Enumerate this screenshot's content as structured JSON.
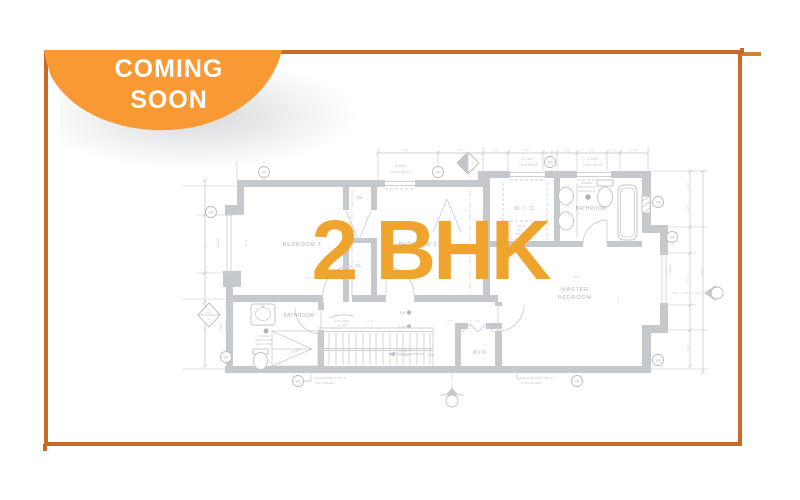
{
  "badge": {
    "line1": "COMING",
    "line2": "SOON",
    "bg_color": "#f99933",
    "text_color": "#ffffff"
  },
  "frame": {
    "border_color": "#cb6a28"
  },
  "overlay": {
    "title": "2 BHK",
    "color": "#efa42d"
  },
  "floorplan": {
    "wall_color": "#c5c9cd",
    "labels": [
      {
        "t": "BEDROOM 3",
        "x": 302,
        "y": 246,
        "s": 5.5,
        "k": "room",
        "ls": 0.6
      },
      {
        "t": "BEDROOM 2",
        "x": 418,
        "y": 246,
        "s": 5.5,
        "k": "room",
        "ls": 0.6
      },
      {
        "t": "CL.",
        "x": 360,
        "y": 199,
        "s": 4.5,
        "k": "room"
      },
      {
        "t": "CL.",
        "x": 359,
        "y": 267,
        "s": 4.5,
        "k": "room"
      },
      {
        "t": "W. I. C.",
        "x": 525,
        "y": 210,
        "s": 5.5,
        "k": "room",
        "ls": 0.5
      },
      {
        "t": "BATHROOM",
        "x": 591,
        "y": 210,
        "s": 5,
        "k": "room",
        "ls": 0.3
      },
      {
        "t": "MASTER",
        "x": 575,
        "y": 291,
        "s": 5.5,
        "k": "room",
        "ls": 0.8
      },
      {
        "t": "BEDROOM",
        "x": 575,
        "y": 299,
        "s": 5.5,
        "k": "room",
        "ls": 0.8
      },
      {
        "t": "BATHROOM",
        "x": 299,
        "y": 317,
        "s": 5,
        "k": "room",
        "ls": 0.3
      },
      {
        "t": "W / D",
        "x": 479,
        "y": 354,
        "s": 5,
        "k": "room"
      },
      {
        "t": "DOWN",
        "x": 296,
        "y": 352,
        "s": 3.4,
        "k": "dim",
        "r": -18
      },
      {
        "t": "DN",
        "x": 430,
        "y": 356,
        "s": 4,
        "k": "dim"
      },
      {
        "t": "SA",
        "x": 405,
        "y": 314,
        "s": 4,
        "k": "room",
        "a": "end"
      },
      {
        "t": "CO",
        "x": 405,
        "y": 328,
        "s": 4,
        "k": "room",
        "a": "end"
      },
      {
        "t": "5'-8\" HIGH",
        "x": 342,
        "y": 322,
        "s": 3,
        "k": "dim"
      },
      {
        "t": "GUARD",
        "x": 342,
        "y": 326.5,
        "s": 3,
        "k": "dim"
      },
      {
        "t": "16R@7'-7\"",
        "x": 406,
        "y": 351.5,
        "s": 3,
        "k": "dim"
      },
      {
        "t": "15T@10\"",
        "x": 405,
        "y": 356,
        "s": 3,
        "k": "dim"
      },
      {
        "t": "PROVIDE",
        "x": 264,
        "y": 337,
        "s": 2.6,
        "k": "dim"
      },
      {
        "t": "MECHANICAL",
        "x": 264,
        "y": 341,
        "s": 2.6,
        "k": "dim"
      },
      {
        "t": "VENTILATION",
        "x": 264,
        "y": 345,
        "s": 2.6,
        "k": "dim"
      },
      {
        "t": "PROVIDE",
        "x": 587,
        "y": 184,
        "s": 2.6,
        "k": "dim"
      },
      {
        "t": "MECHANICAL",
        "x": 587,
        "y": 188,
        "s": 2.6,
        "k": "dim"
      },
      {
        "t": "VENTILATION",
        "x": 587,
        "y": 192,
        "s": 2.6,
        "k": "dim"
      },
      {
        "t": "PROVIDE 5/8\" TYPE 'X'",
        "x": 314,
        "y": 379,
        "s": 3,
        "k": "dim",
        "a": "start"
      },
      {
        "t": "GYPS. BOARD",
        "x": 314,
        "y": 384,
        "s": 3,
        "k": "dim",
        "a": "start"
      },
      {
        "t": "PROVIDE 5/8\" TYPE 'X'",
        "x": 521,
        "y": 379,
        "s": 3,
        "k": "dim",
        "a": "start"
      },
      {
        "t": "GYPS. BOARD",
        "x": 521,
        "y": 384,
        "s": 3,
        "k": "dim",
        "a": "start"
      },
      {
        "t": "12\"x36\"",
        "x": 522,
        "y": 227,
        "s": 2.7,
        "k": "dim"
      },
      {
        "t": "ARC",
        "x": 519,
        "y": 231,
        "s": 2.7,
        "k": "dim"
      },
      {
        "t": "SPEC",
        "x": 519,
        "y": 235,
        "s": 2.7,
        "k": "dim"
      },
      {
        "t": "2-2x8+",
        "x": 401,
        "y": 167,
        "s": 4,
        "k": "hdr"
      },
      {
        "t": "L4x3.5x1/4",
        "x": 401,
        "y": 173,
        "s": 4,
        "k": "hdr"
      },
      {
        "t": "2-2x8+",
        "x": 528,
        "y": 160,
        "s": 4,
        "k": "hdr"
      },
      {
        "t": "L4x3.5x1/4",
        "x": 528,
        "y": 166,
        "s": 4,
        "k": "hdr"
      },
      {
        "t": "2-2x8+",
        "x": 593,
        "y": 160,
        "s": 4,
        "k": "hdr"
      },
      {
        "t": "L4x3.5x1/4",
        "x": 593,
        "y": 166,
        "s": 4,
        "k": "hdr"
      },
      {
        "t": "6'-8\"",
        "x": 405,
        "y": 151,
        "s": 3,
        "k": "dim"
      },
      {
        "t": "7'-8\"",
        "x": 459,
        "y": 151,
        "s": 3,
        "k": "dim"
      },
      {
        "t": "1'-4\"",
        "x": 496,
        "y": 151,
        "s": 3,
        "k": "dim"
      },
      {
        "t": "3'-4\"",
        "x": 526,
        "y": 151,
        "s": 3,
        "k": "dim"
      },
      {
        "t": "2'-0\"",
        "x": 567,
        "y": 151,
        "s": 3,
        "k": "dim"
      },
      {
        "t": "1'-4\"",
        "x": 592,
        "y": 151,
        "s": 3,
        "k": "dim"
      },
      {
        "t": "1'-4\"",
        "x": 613,
        "y": 151,
        "s": 3,
        "k": "dim"
      },
      {
        "t": "1'-6\"",
        "x": 634,
        "y": 151,
        "s": 3,
        "k": "dim"
      },
      {
        "t": "2-2x10",
        "x": 219,
        "y": 243,
        "s": 3.4,
        "k": "hdr",
        "r": -90
      },
      {
        "t": "2-2x8+",
        "x": 222,
        "y": 327,
        "s": 2.8,
        "k": "hdr",
        "r": -90
      },
      {
        "t": "L4x3.5x1/4",
        "x": 227,
        "y": 327,
        "s": 2.8,
        "k": "hdr",
        "r": -90
      },
      {
        "t": "2-2x10",
        "x": 671,
        "y": 270,
        "s": 3.4,
        "k": "hdr",
        "r": -90
      },
      {
        "t": "16'-6\"",
        "x": 703,
        "y": 272,
        "s": 3,
        "k": "dim",
        "r": -90
      },
      {
        "t": "1'-6\"",
        "x": 689,
        "y": 186,
        "s": 3,
        "k": "dim",
        "r": -90
      },
      {
        "t": "4'-6\"",
        "x": 689,
        "y": 208,
        "s": 3,
        "k": "dim",
        "r": -90
      },
      {
        "t": "7'-4\"",
        "x": 689,
        "y": 280,
        "s": 3,
        "k": "dim",
        "r": -90
      },
      {
        "t": "4'-6\"",
        "x": 689,
        "y": 348,
        "s": 3,
        "k": "dim",
        "r": -90
      },
      {
        "t": "7'-4\"",
        "x": 619,
        "y": 300,
        "s": 3,
        "k": "dim",
        "r": -90
      },
      {
        "t": "11'-6\"",
        "x": 247,
        "y": 243,
        "s": 3,
        "k": "dim",
        "r": -90
      },
      {
        "t": "9'-0\"",
        "x": 206,
        "y": 246,
        "s": 3,
        "k": "dim",
        "r": -90
      },
      {
        "t": "7'-0\"",
        "x": 206,
        "y": 330,
        "s": 3,
        "k": "dim",
        "r": -90
      },
      {
        "t": "7'-4\"",
        "x": 350,
        "y": 224,
        "s": 3,
        "k": "dim",
        "r": -90
      },
      {
        "t": "11'-6\"",
        "x": 310,
        "y": 279,
        "s": 3,
        "k": "dim"
      },
      {
        "t": "10'-6\"",
        "x": 576,
        "y": 278,
        "s": 3,
        "k": "dim"
      },
      {
        "t": "7'-4\"",
        "x": 370,
        "y": 322,
        "s": 3,
        "k": "dim"
      },
      {
        "t": "1'-4\"",
        "x": 238,
        "y": 272,
        "s": 2.7,
        "k": "dim"
      },
      {
        "t": "2'-6\"",
        "x": 450,
        "y": 322,
        "s": 2.7,
        "k": "dim"
      },
      {
        "t": "4'-0\"",
        "x": 478,
        "y": 322,
        "s": 2.7,
        "k": "dim"
      },
      {
        "t": "A-40",
        "x": 209,
        "y": 313.5,
        "s": 2.4,
        "k": "dim"
      },
      {
        "t": "A",
        "x": 209,
        "y": 320,
        "s": 3,
        "k": "dim"
      },
      {
        "t": "B",
        "x": 472.5,
        "y": 165,
        "s": 3,
        "k": "dim"
      }
    ],
    "markers": [
      {
        "t": "W3",
        "x": 264,
        "y": 172
      },
      {
        "t": "W3",
        "x": 438,
        "y": 172
      },
      {
        "t": "W3",
        "x": 550,
        "y": 162
      },
      {
        "t": "W4",
        "x": 211,
        "y": 212
      },
      {
        "t": "W5",
        "x": 226,
        "y": 357
      },
      {
        "t": "W3",
        "x": 658,
        "y": 202
      },
      {
        "t": "W4",
        "x": 672,
        "y": 237
      },
      {
        "t": "W3",
        "x": 658,
        "y": 360
      },
      {
        "t": "W5",
        "x": 298,
        "y": 381
      },
      {
        "t": "W3",
        "x": 577,
        "y": 381
      }
    ]
  }
}
